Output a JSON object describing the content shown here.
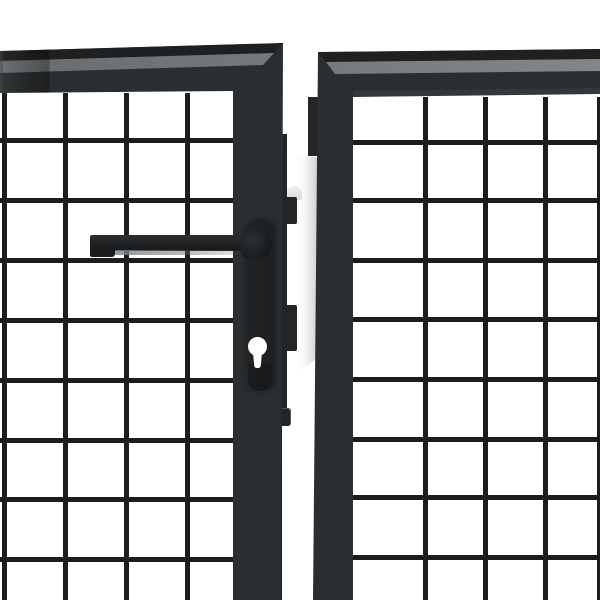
{
  "scene": {
    "type": "product-photo",
    "alt": "Close-up of an anthracite grey steel wire-mesh double garden gate: two gate leaves with welded square mesh, dark lever handle and euro-cylinder keyhole on the left leaf, white gate post visible in the centre gap",
    "background": "#ffffff"
  },
  "colors": {
    "background": "#ffffff",
    "frame_face": "#2b2e30",
    "frame_top_band": "#1e2022",
    "frame_highlight_left": "#6a6d6f",
    "frame_highlight_right": "#838688",
    "frame_bevel_light": "#44474a",
    "mesh_wire": "#1a1c1d",
    "stile": "#232527",
    "handle_dark": "#17191b",
    "handle_mid": "#2c2f31",
    "escutcheon": "#212325",
    "keyhole_fill": "#ffffff",
    "post_white": "#ffffff",
    "post_shadow": "#cdcfd1",
    "hinge_light": "#f0f1f2"
  },
  "mesh": {
    "wire_thickness": 5,
    "cell_size": 60,
    "left": {
      "area": {
        "x": 0,
        "y": 93,
        "w": 233,
        "h": 507
      },
      "vertical_x": [
        2,
        63,
        124,
        185
      ],
      "horizontal_y": [
        138,
        198,
        258,
        318,
        378,
        438,
        497,
        557
      ]
    },
    "right": {
      "area": {
        "x": 353,
        "y": 97,
        "w": 247,
        "h": 503
      },
      "vertical_x": [
        423,
        483,
        543,
        597
      ],
      "horizontal_y": [
        140,
        198,
        258,
        317,
        377,
        437,
        495,
        555
      ]
    }
  },
  "components": {
    "left_leaf": "left gate leaf",
    "right_leaf": "right gate leaf",
    "handle": "lever handle",
    "keyhole": "euro cylinder keyhole",
    "post": "gate post"
  }
}
